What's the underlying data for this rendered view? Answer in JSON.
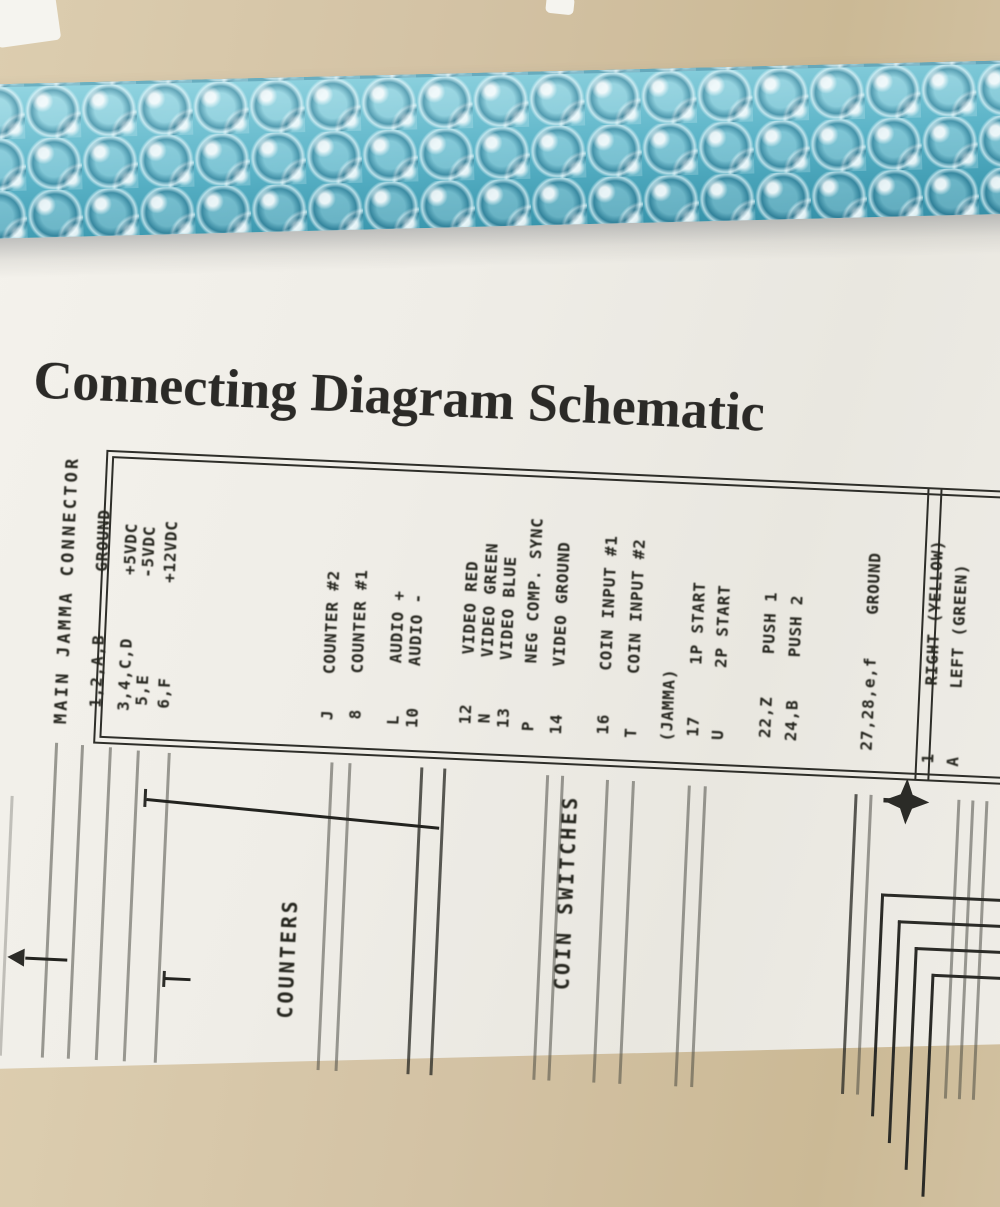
{
  "document": {
    "title": "Connecting Diagram Schematic",
    "main_connector": {
      "header": "MAIN JAMMA CONNECTOR",
      "rows": [
        {
          "pin": "1,2,A,B",
          "label": "GROUND"
        },
        {
          "pin": "3,4,C,D",
          "label": "+5VDC"
        },
        {
          "pin": "5,E",
          "label": "-5VDC"
        },
        {
          "pin": "6,F",
          "label": "+12VDC"
        },
        {
          "pin": "J",
          "label": "COUNTER #2"
        },
        {
          "pin": "8",
          "label": "COUNTER #1"
        },
        {
          "pin": "L",
          "label": "AUDIO +"
        },
        {
          "pin": "10",
          "label": "AUDIO -"
        },
        {
          "pin": "12",
          "label": "VIDEO RED"
        },
        {
          "pin": "N",
          "label": "VIDEO GREEN"
        },
        {
          "pin": "13",
          "label": "VIDEO BLUE"
        },
        {
          "pin": "P",
          "label": "NEG COMP. SYNC"
        },
        {
          "pin": "14",
          "label": "VIDEO GROUND"
        },
        {
          "pin": "16",
          "label": "COIN INPUT #1"
        },
        {
          "pin": "T",
          "label": "COIN INPUT #2"
        },
        {
          "pin": "(JAMMA)",
          "label": ""
        },
        {
          "pin": "17",
          "label": "1P START"
        },
        {
          "pin": "U",
          "label": "2P START"
        },
        {
          "pin": "22,Z",
          "label": "PUSH 1"
        },
        {
          "pin": "24,B",
          "label": "PUSH 2"
        },
        {
          "pin": "27,28,e,f",
          "label": "GROUND"
        }
      ]
    },
    "side_connector": {
      "rows": [
        {
          "pin": "1",
          "label": "RIGHT (YELLOW)"
        },
        {
          "pin": "A",
          "label": "LEFT (GREEN)"
        }
      ]
    },
    "wire_labels": {
      "counters": "COUNTERS",
      "coin_switches": "COIN SWITCHES"
    }
  },
  "photo": {
    "colors": {
      "cardboard": "#d3c2a4",
      "bubble_wrap": "#5fb6c9",
      "paper": "#efede7",
      "ink": "#26261f"
    }
  }
}
